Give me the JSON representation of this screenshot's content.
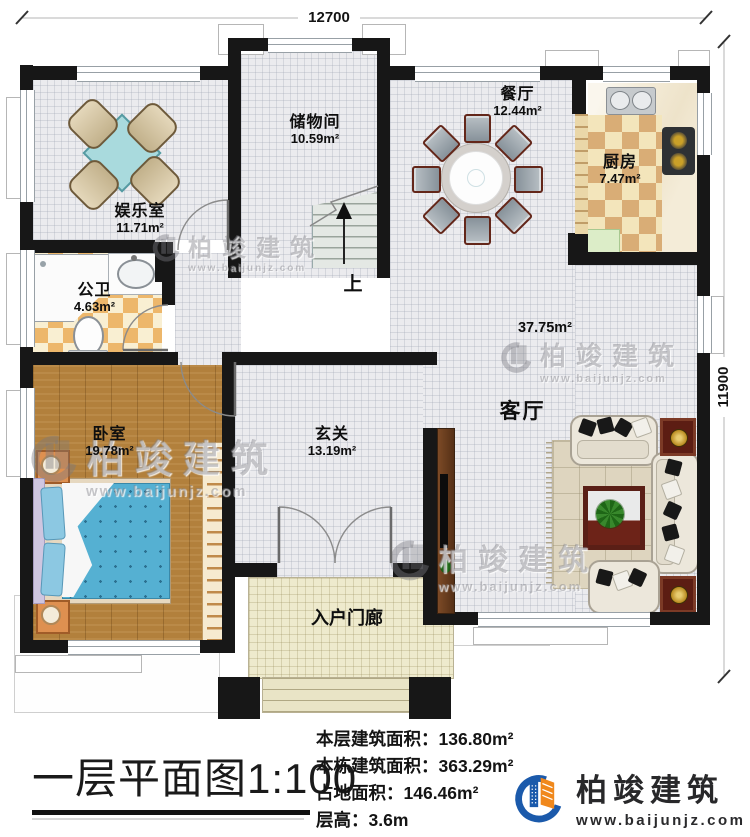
{
  "plan": {
    "scale_title": "一层平面图1:100",
    "dim_top": "12700",
    "dim_right": "11900",
    "stairs_up": "上",
    "rooms": {
      "entertainment": {
        "name": "娱乐室",
        "area": "11.71m²"
      },
      "storage": {
        "name": "储物间",
        "area": "10.59m²"
      },
      "dining": {
        "name": "餐厅",
        "area": "12.44m²"
      },
      "kitchen": {
        "name": "厨房",
        "area": "7.47m²"
      },
      "bathroom": {
        "name": "公卫",
        "area": "4.63m²"
      },
      "bedroom": {
        "name": "卧室",
        "area": "19.78m²"
      },
      "foyer": {
        "name": "玄关",
        "area": "13.19m²"
      },
      "living": {
        "name": "客厅",
        "area": "37.75m²"
      },
      "porch": {
        "name": "入户门廊"
      }
    }
  },
  "info": {
    "rows": [
      {
        "label": "本层建筑面积：",
        "value": "136.80m²"
      },
      {
        "label": "本栋建筑面积：",
        "value": "363.29m²"
      },
      {
        "label": "占地面积：",
        "value": "146.46m²"
      },
      {
        "label": "层高：",
        "value": "3.6m"
      }
    ]
  },
  "branding": {
    "company": "柏竣建筑",
    "website": "www.baijunjz.com"
  },
  "colors": {
    "wall": "#171717",
    "accent_blue": "#1b5aab",
    "accent_orange": "#f0881c"
  }
}
